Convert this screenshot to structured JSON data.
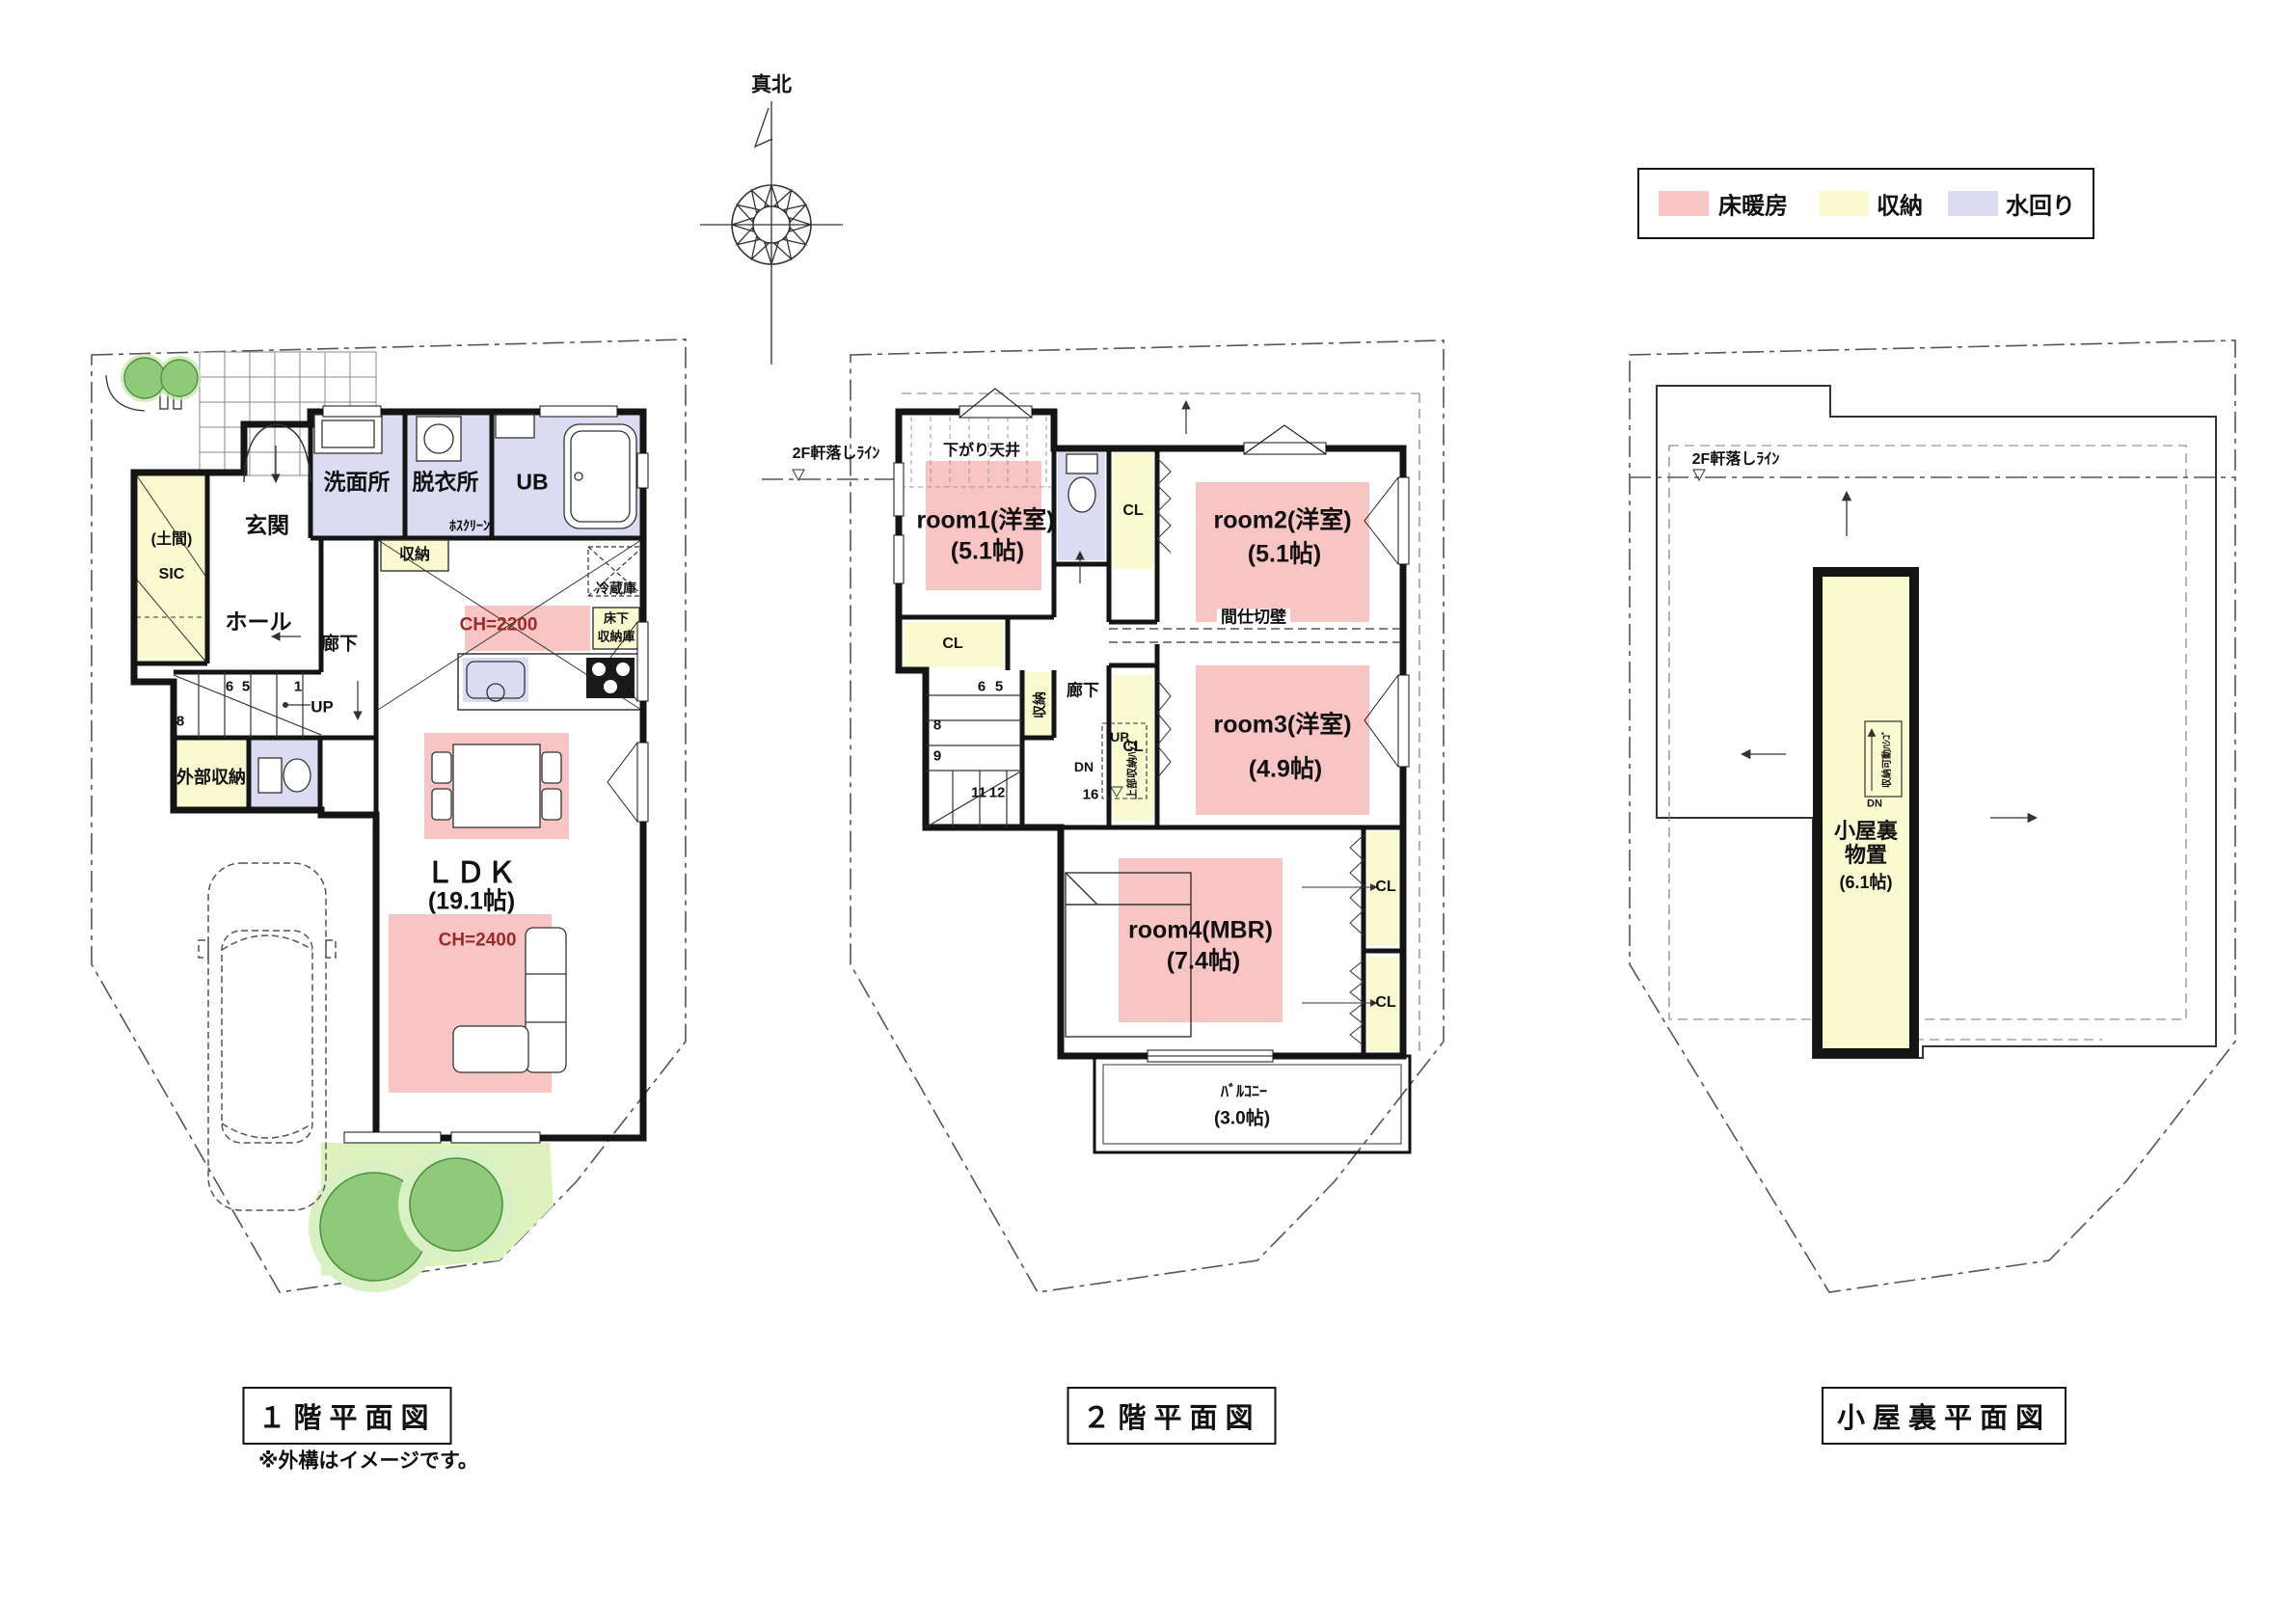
{
  "compass": {
    "label": "真北"
  },
  "legend": {
    "items": [
      {
        "label": "床暖房",
        "color": "#F8C5C4"
      },
      {
        "label": "収納",
        "color": "#FAFAD0"
      },
      {
        "label": "水回り",
        "color": "#DBDBF2"
      }
    ]
  },
  "floor1": {
    "title": "１階平面図",
    "note": "※外構はイメージです。",
    "labels": {
      "washroom": "洗面所",
      "dressing": "脱衣所",
      "hoscreen": "ﾎｽｸﾘｰﾝ",
      "bath": "UB",
      "entrance": "玄関",
      "doma": "(土間)",
      "sic": "SIC",
      "hall": "ホール",
      "corridor": "廊下",
      "closet": "収納",
      "fridge": "冷蔵庫",
      "ch_kitchen": "CH=2200",
      "underfloor1": "床下",
      "underfloor2": "収納庫",
      "up": "UP",
      "n6": "6",
      "n5": "5",
      "n1": "1",
      "n8": "8",
      "ext_storage": "外部収納",
      "ldk": "ＬＤＫ",
      "ldk_size": "(19.1帖)",
      "ch_living": "CH=2400"
    }
  },
  "floor2": {
    "title": "２階平面図",
    "labels": {
      "eave": "2F軒落しﾗｲﾝ",
      "lowered_ceiling": "下がり天井",
      "room1": "room1(洋室)",
      "room1_size": "(5.1帖)",
      "cl": "CL",
      "room2": "room2(洋室)",
      "room2_size": "(5.1帖)",
      "partition": "間仕切壁",
      "room3": "room3(洋室)",
      "room3_size": "(4.9帖)",
      "corridor": "廊下",
      "closet_v": "収納",
      "ladder_v": "上部収納ﾊｼｺﾞ",
      "room4": "room4(MBR)",
      "room4_size": "(7.4帖)",
      "balcony": "ﾊﾞﾙｺﾆｰ",
      "balcony_size": "(3.0帖)",
      "up": "UP",
      "dn": "DN",
      "n6": "6",
      "n5": "5",
      "n8": "8",
      "n9": "9",
      "n11": "11",
      "n12": "12",
      "n16": "16"
    }
  },
  "floor3": {
    "title": "小屋裏平面図",
    "labels": {
      "eave": "2F軒落しﾗｲﾝ",
      "name1": "小屋裏",
      "name2": "物置",
      "size": "(6.1帖)",
      "ladder": "収納可動ﾊｼｺﾞ",
      "dn": "DN"
    }
  }
}
